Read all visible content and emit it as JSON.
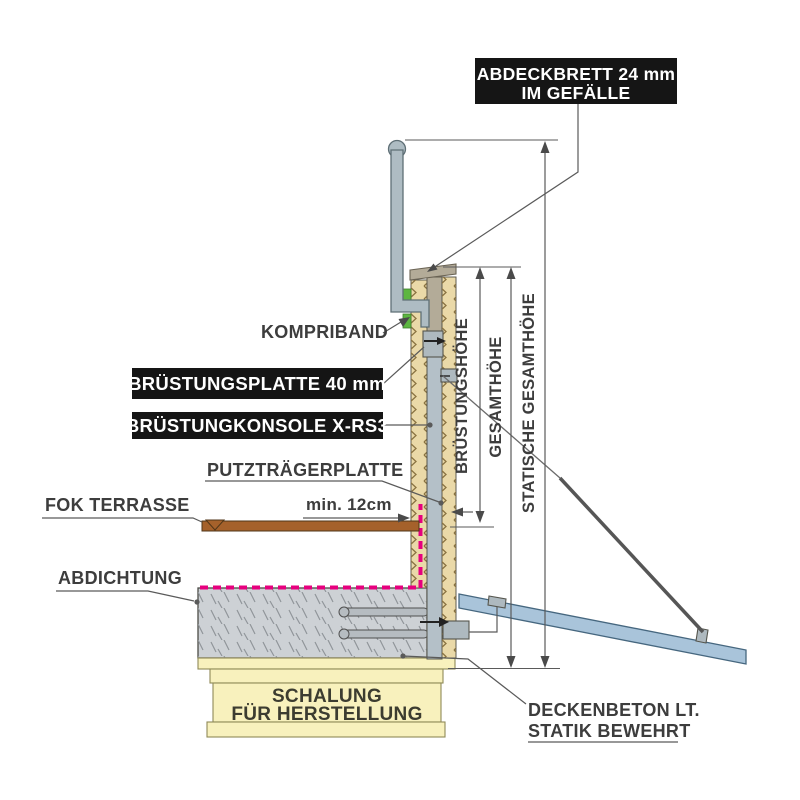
{
  "diagram": {
    "type": "construction-detail-section",
    "labels": {
      "abdeckbrett_line1": "ABDECKBRETT 24 mm",
      "abdeckbrett_line2": "IM GEFÄLLE",
      "kompriband": "KOMPRIBAND",
      "bruestungsplatte": "BRÜSTUNGSPLATTE 40 mm",
      "bruestungskonsole": "BRÜSTUNGKONSOLE X-RS3",
      "putztraegerplatte": "PUTZTRÄGERPLATTE",
      "fok_terrasse": "FOK TERRASSE",
      "min_12cm": "min. 12cm",
      "abdichtung": "ABDICHTUNG",
      "bruestungshoehe": "BRÜSTUNGSHÖHE",
      "gesamthoehe": "GESAMTHÖHE",
      "statische_gesamthoehe": "STATISCHE GESAMTHÖHE",
      "schalung_line1": "SCHALUNG",
      "schalung_line2": "FÜR HERSTELLUNG",
      "deckenbeton_line1": "DECKENBETON LT.",
      "deckenbeton_line2": "STATIK BEWEHRT"
    },
    "colors": {
      "label_box_bg": "#151515",
      "label_box_text": "#ffffff",
      "text_color": "#3d3d3d",
      "line_color": "#5a5a5a",
      "abdichtung_magenta": "#e6007e",
      "kompriband_green": "#5cb640",
      "insulation_fill": "#ead9a8",
      "insulation_hatch": "#8a7342",
      "concrete_fill": "#cdd1d5",
      "concrete_hatch": "#90959a",
      "metal_blue_gray": "#aebcc3",
      "wood_warm_gray": "#b3ab98",
      "terrace_brown": "#a5612b",
      "formwork_yellow": "#f8f1bd",
      "prop_board_blue": "#a9c4da"
    }
  }
}
